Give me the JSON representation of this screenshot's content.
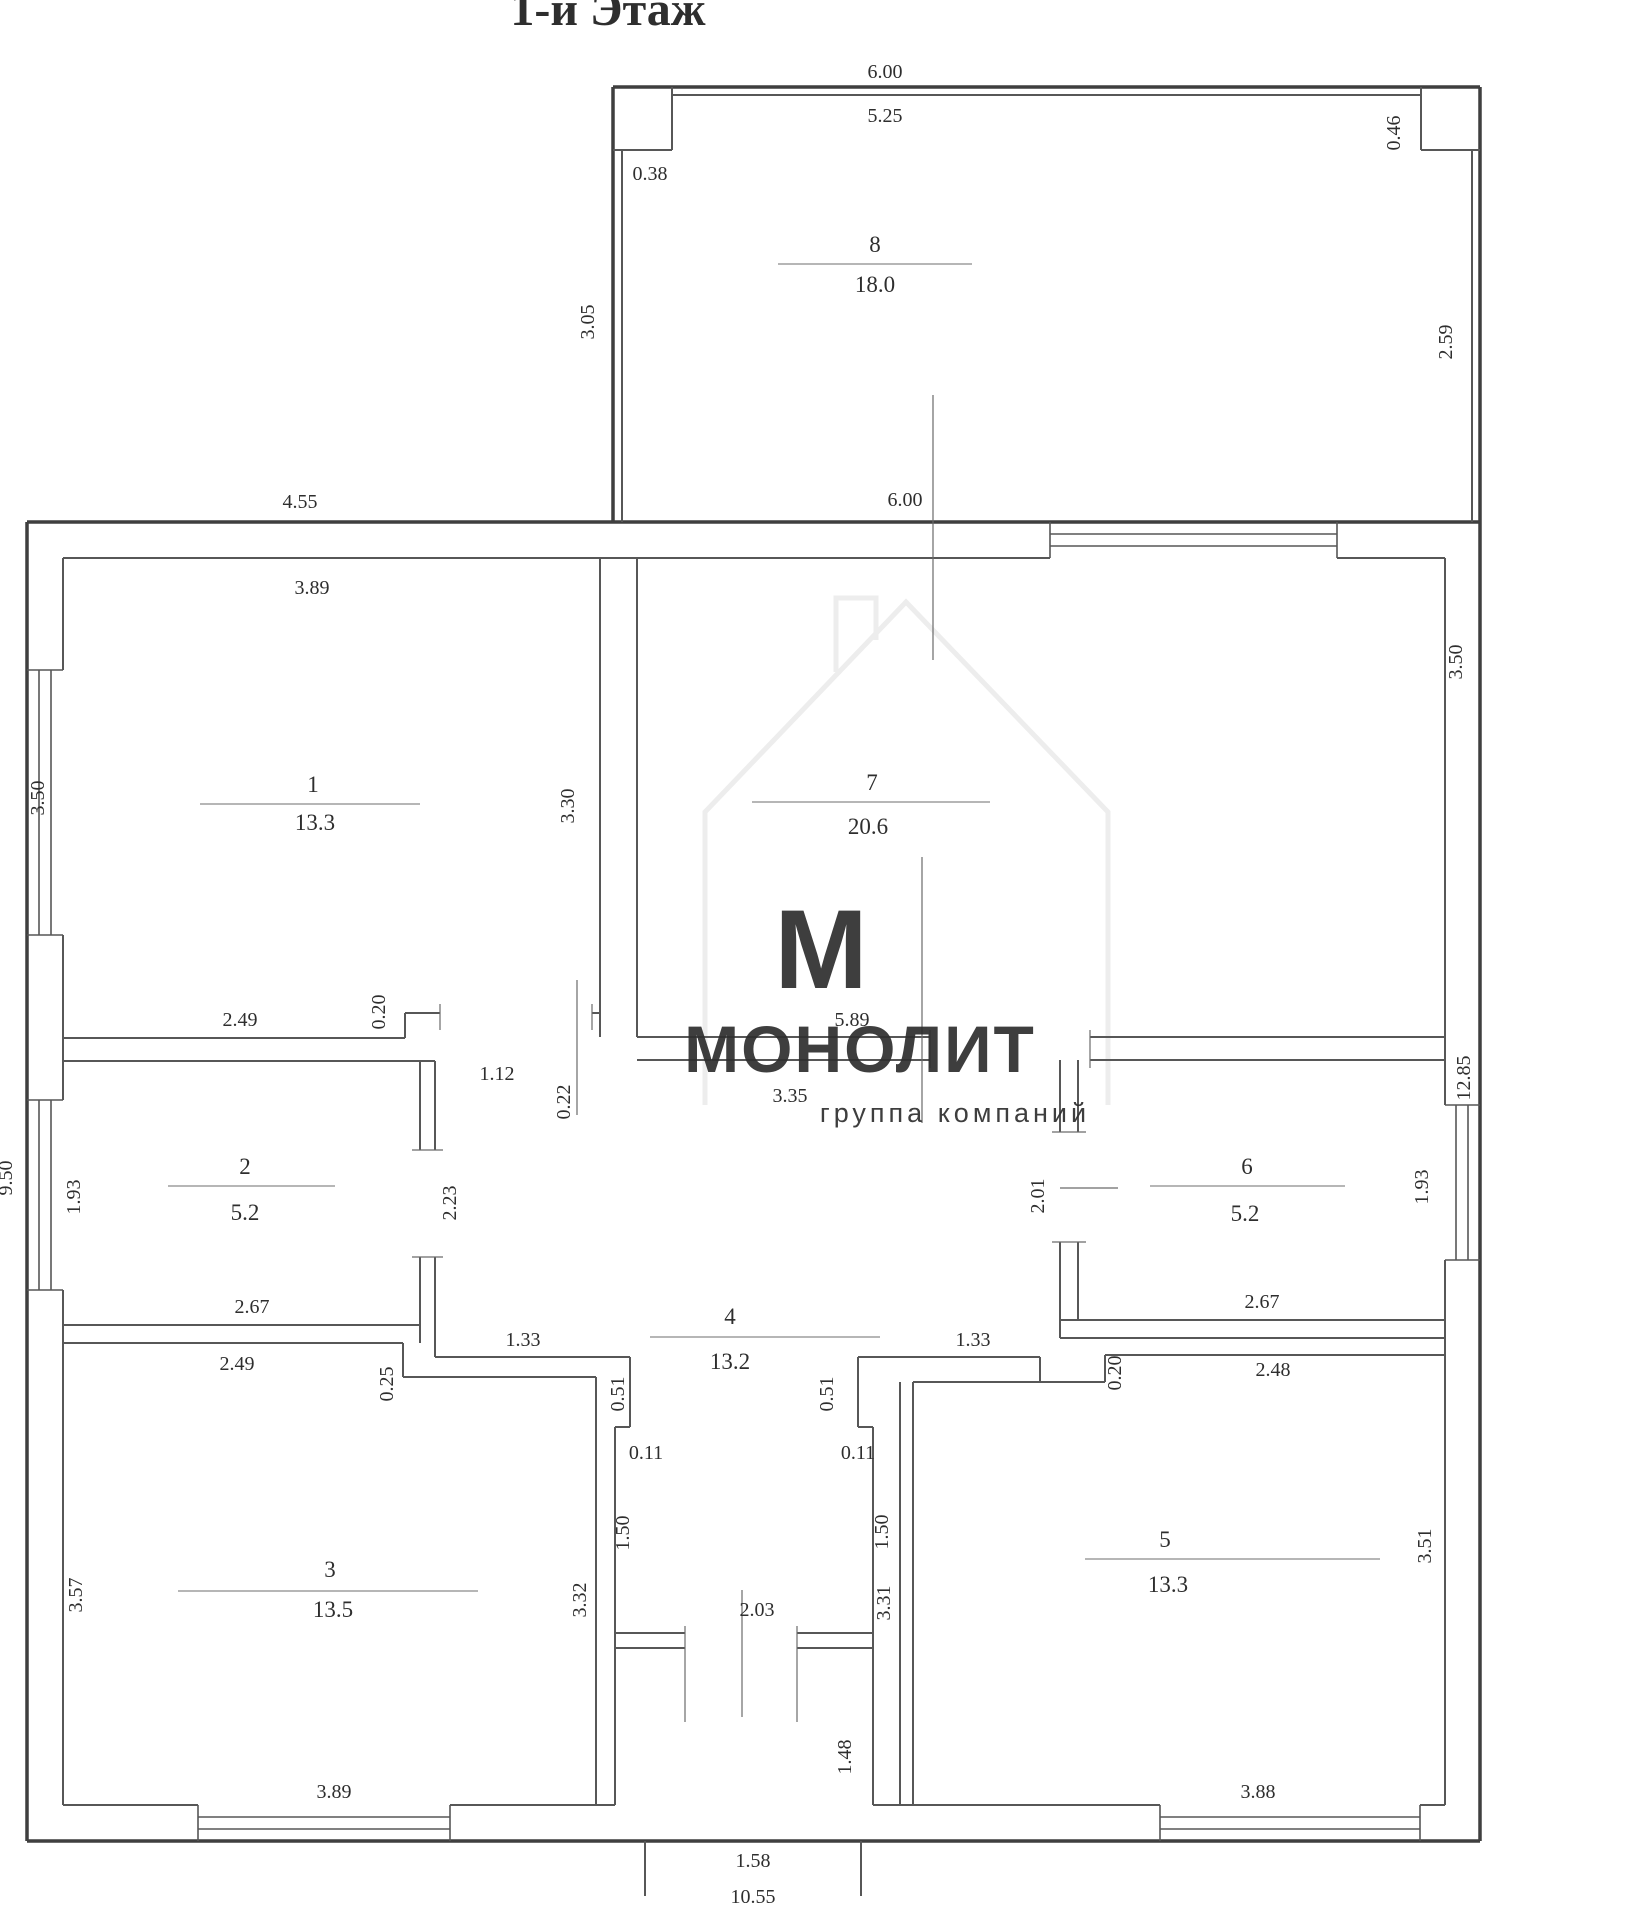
{
  "title": "1-й Этаж",
  "watermark": {
    "letter": "М",
    "name": "МОНОЛИТ",
    "subtitle": "группа компаний",
    "color": "#f6c69d",
    "subtitle_color": "#d9d9d9"
  },
  "colors": {
    "wall_thick": "#3f3f3f",
    "wall_thin": "#575757",
    "tick": "#6a6a6a",
    "label_line": "#8a8a8a",
    "dim_text": "#2e2e2e",
    "background": "#ffffff"
  },
  "rooms": [
    {
      "num": "1",
      "area": "13.3"
    },
    {
      "num": "2",
      "area": "5.2"
    },
    {
      "num": "3",
      "area": "13.5"
    },
    {
      "num": "4",
      "area": "13.2"
    },
    {
      "num": "5",
      "area": "13.3"
    },
    {
      "num": "6",
      "area": "5.2"
    },
    {
      "num": "7",
      "area": "20.6"
    },
    {
      "num": "8",
      "area": "18.0"
    }
  ],
  "dims": {
    "d600_8": "6.00",
    "d525": "5.25",
    "d038": "0.38",
    "d046": "0.46",
    "d305": "3.05",
    "d259": "2.59",
    "d455": "4.55",
    "d600_7": "6.00",
    "d1285": "12.85",
    "d950": "9.50",
    "d389_1": "3.89",
    "d350_1": "3.50",
    "d330": "3.30",
    "d249_1": "2.49",
    "d020_1": "0.20",
    "d112": "1.12",
    "d022": "0.22",
    "d350_7": "3.50",
    "d589": "5.89",
    "d335": "3.35",
    "d193_2": "1.93",
    "d267_2": "2.67",
    "d223": "2.23",
    "d201": "2.01",
    "d193_6": "1.93",
    "d267_6": "2.67",
    "d249_3": "2.49",
    "d025": "0.25",
    "d357": "3.57",
    "d332": "3.32",
    "d389_3": "3.89",
    "d248": "2.48",
    "d020_5": "0.20",
    "d331": "3.31",
    "d351": "3.51",
    "d388": "3.88",
    "d133_l": "1.33",
    "d133_r": "1.33",
    "d051_l": "0.51",
    "d051_r": "0.51",
    "d011_l": "0.11",
    "d011_r": "0.11",
    "d150_l": "1.50",
    "d150_r": "1.50",
    "d203": "2.03",
    "d148": "1.48",
    "d158": "1.58",
    "d1055": "10.55"
  }
}
